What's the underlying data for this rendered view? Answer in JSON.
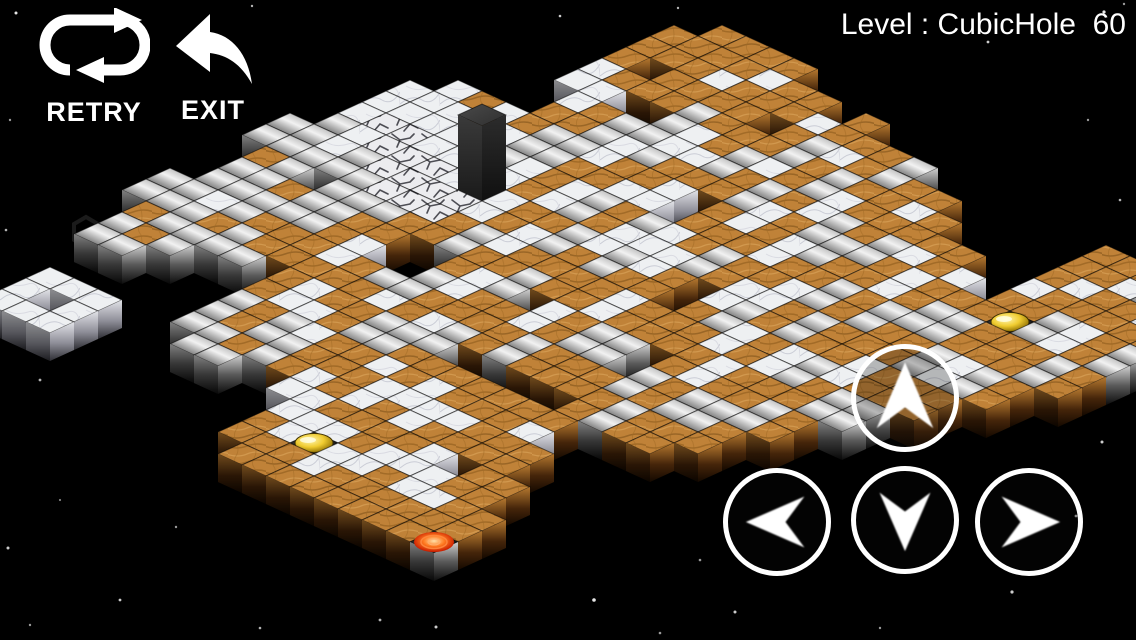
{
  "hud": {
    "retry_label": "RETRY",
    "exit_label": "EXIT",
    "level_label": "Level : CubicHole  60"
  },
  "dpad": {
    "buttons": [
      {
        "dir": "up"
      },
      {
        "dir": "left"
      },
      {
        "dir": "down"
      },
      {
        "dir": "right"
      }
    ]
  },
  "colors": {
    "background": "#000000",
    "wood": "#c08238",
    "wood_grain": "#96611f",
    "marble": "#eef0f2",
    "marble_vein": "#c2c4cf",
    "metal_light": "#f2f2f2",
    "metal_dark": "#262626",
    "cracked": "#ececef",
    "crack_line": "#33333a",
    "pillar": "#3c3c3c",
    "coin_gold": "#e8c520",
    "goal_red": "#cc2000",
    "hud_white": "#ffffff"
  },
  "board": {
    "origin_x": -118,
    "origin_y": 300,
    "step_x": 24,
    "step_y": 11,
    "cube_height": 28,
    "pillar_height": 75,
    "legend": {
      ".": "empty",
      "w": "wood-tile",
      "m": "marble-tile",
      "s": "metal-tile",
      "c": "cracked-tile",
      "g": "gold-coin-tile",
      "r": "red-goal-tile",
      "p": "pillar-tile"
    },
    "map": [
      "..........ss...ss.............",
      ".......sswsssswsssmmm.........",
      "..mmm..swssmssssmmcmmm........",
      "..m.m...sswssw.ssccmmw........",
      "..mmm....sswssssccmmwm..mmwww.",
      ".........swwssscccmmmwwmmw.www",
      "..........wwwwsccmmsssww.wwwww",
      ".....ssswwwmmwwccpmmssss.wwmww",
      "....sswwmmww..wwmmwwwmmssswwmw",
      "....swssmwws..sswwmmwwsmmwwww.",
      ".....ssmwwmsswwmmwssmwwmww.ww.",
      ".....wwwsswwmmwwsswwmmwsswwm..",
      "....mmwwssmwwsswwmms..wwmssww.",
      ".wwmmwwmwssww.wwssmmwwsswwmw..",
      "wwmmwmmww.wwmmwwwmmwwmmwssww..",
      "wwgmwwmmw.sswwmmwwsswwwmmwss..",
      "wmmwwmmww.wwssww..wwmmsswww...",
      "wwmmwwmww.wwsswwwmmwwsswwmw...",
      "wwwmmwwww.ww..wwssmmwwssww....",
      "wwmm.wwmwwwsswwmmwwsswwmw.....",
      "wwmwwww..sswwmmwwsswwmmww.....",
      "wwwww....wwsswwmmwwsswwm......",
      "rww......wwsswwsswwwssw.......",
      "..........wwsswwmmwwsswwmwww..",
      "............wwsswwsswwgwwmww..",
      "..............sswwmmwwsswwmw..",
      "................wwsswwmmwwsw..",
      "..................wwsswwwmw...",
      "....................wwssww...."
    ]
  },
  "ghost_glyph": {
    "x": 86,
    "y": 232
  },
  "stars": [
    [
      16,
      13,
      1.5,
      0.9
    ],
    [
      252,
      6,
      1.2,
      0.7
    ],
    [
      560,
      16,
      1.3,
      0.8
    ],
    [
      678,
      8,
      1.2,
      0.7
    ],
    [
      1104,
      12,
      1.6,
      0.9
    ],
    [
      988,
      42,
      1.4,
      0.8
    ],
    [
      1124,
      4,
      1.2,
      0.6
    ],
    [
      870,
      30,
      1.1,
      0.5
    ],
    [
      10,
      120,
      1.2,
      0.6
    ],
    [
      6,
      230,
      1.3,
      0.7
    ],
    [
      40,
      380,
      1.4,
      0.7
    ],
    [
      8,
      548,
      1.5,
      0.8
    ],
    [
      60,
      500,
      1.1,
      0.5
    ],
    [
      120,
      600,
      1.4,
      0.8
    ],
    [
      30,
      625,
      1.2,
      0.6
    ],
    [
      260,
      628,
      1.3,
      0.7
    ],
    [
      380,
      620,
      1.4,
      0.7
    ],
    [
      436,
      627,
      1.5,
      0.8
    ],
    [
      594,
      600,
      1.8,
      0.9
    ],
    [
      660,
      633,
      1.3,
      0.6
    ],
    [
      735,
      612,
      1.5,
      0.8
    ],
    [
      880,
      628,
      1.2,
      0.6
    ],
    [
      1012,
      592,
      1.6,
      0.8
    ],
    [
      1076,
      516,
      1.4,
      0.7
    ],
    [
      1102,
      442,
      1.5,
      0.8
    ],
    [
      1128,
      350,
      1.2,
      0.6
    ],
    [
      1120,
      200,
      1.3,
      0.7
    ],
    [
      1088,
      120,
      1.2,
      0.6
    ],
    [
      596,
      377,
      2,
      0.9
    ],
    [
      176,
      527,
      1.2,
      0.6
    ],
    [
      700,
      560,
      1.3,
      0.6
    ]
  ]
}
